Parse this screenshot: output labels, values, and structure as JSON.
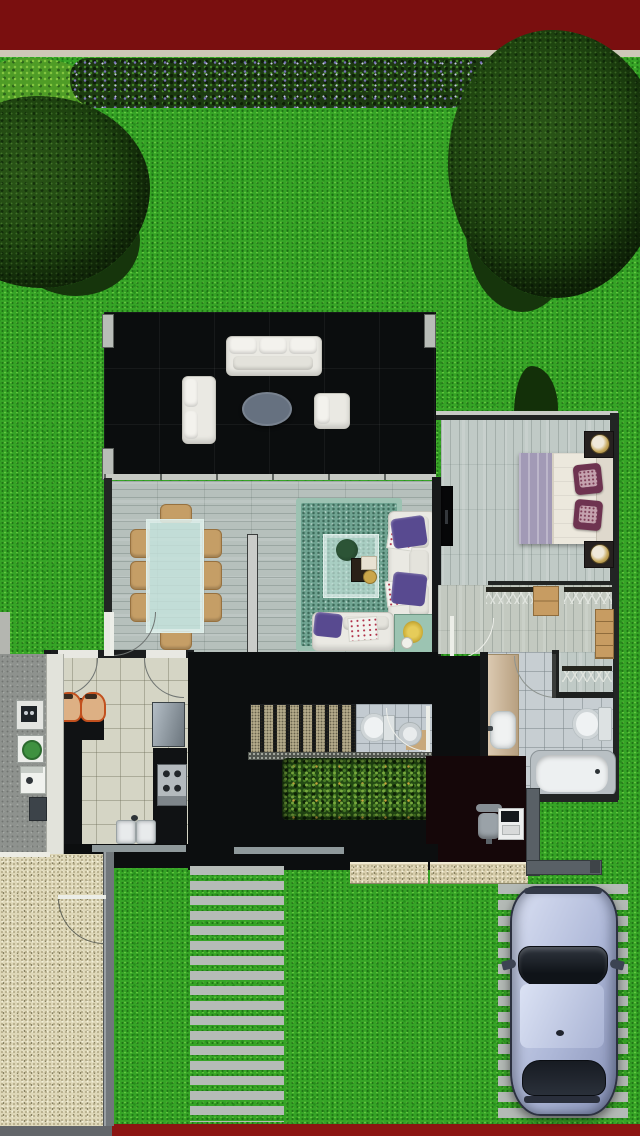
{
  "scene": {
    "type": "top-down 3d rendered house floor plan with garden",
    "canvas": {
      "width": 640,
      "height": 1136
    }
  },
  "frame": {
    "top_bar_color": "#7a0f0f",
    "top_sill_color": "#cdc8b8",
    "bottom_bar_color": "#8c1512",
    "bottom_left_curb_color": "#63666a"
  },
  "garden": {
    "lawn_color": "#36a426",
    "flower_hedge": {
      "foliage": "#1c3a11",
      "flower_colors": [
        "#7a71bc",
        "#c7cbe4"
      ]
    },
    "trees": [
      {
        "name": "tree-top-left",
        "canopy_color": "#1d420f"
      },
      {
        "name": "tree-top-right",
        "canopy_color": "#1d420f"
      }
    ],
    "courtyard_planter": {
      "foliage_colors": [
        "#79aa3e",
        "#4a7f26"
      ],
      "accent_color": "#c9a43c"
    },
    "stepping_stone_path": {
      "stone_count": 17,
      "stone_color": "#b5bbb7"
    },
    "driveway": {
      "slab_count": 15,
      "slab_color": "#b4bab6"
    }
  },
  "exterior": {
    "concrete_pad_color": "#8e928e",
    "walkway_color": "#e2e3db",
    "utility_meter_count": 4,
    "gravel_patio_color": "#ded7b8",
    "patio_wall_color": "#71777b",
    "porch_step_color": "#d9cfae",
    "car": {
      "body_color": "#aeb8d8",
      "glass_color": "#1c2128",
      "facing": "up"
    }
  },
  "house": {
    "terrace": {
      "floor_color": "#0b0d0e",
      "furniture": [
        "three-seat-sofa",
        "loveseat",
        "oval-coffee-table",
        "armchair"
      ]
    },
    "dining_room": {
      "floor": "wood-plank",
      "table": "glass-rectangular",
      "chair_count": 8,
      "chair_color": "#c59e66"
    },
    "living_room": {
      "floor": "wood-plank",
      "rug_color": "#6fa391",
      "sofa_color": "#eae9e3",
      "pillow_color": "#584a90",
      "furniture": [
        "l-shaped-sofa",
        "glass-coffee-table",
        "side-table",
        "wall-tv"
      ]
    },
    "bedroom": {
      "floor": "wood-plank",
      "bed_throw_color": "#a29ab6",
      "duvet_color": "#ece8dd",
      "pillow_color": "#6e3350",
      "furniture": [
        "double-bed",
        "nightstand-2",
        "lamp-2",
        "wall-tv"
      ]
    },
    "walk_in_closet": {
      "hanger_rail_count": 3,
      "dresser_color": "#c79c62"
    },
    "bathroom": {
      "tile_color": "#c7ced2",
      "fixtures": [
        "vanity-sink",
        "toilet",
        "bathtub"
      ]
    },
    "powder_room": {
      "tile_color": "#c3cbd1",
      "fixtures": [
        "toilet",
        "round-sink"
      ]
    },
    "kitchen": {
      "tile_color": "#d5d5c5",
      "fixtures": [
        "l-shaped-counter",
        "bar-stool-2",
        "refrigerator",
        "cooktop",
        "double-sink"
      ]
    },
    "stairs": {
      "tread_count": 8,
      "tread_color": "#b2a888"
    },
    "study": {
      "furniture": [
        "desk",
        "office-chair",
        "laptop"
      ]
    }
  }
}
